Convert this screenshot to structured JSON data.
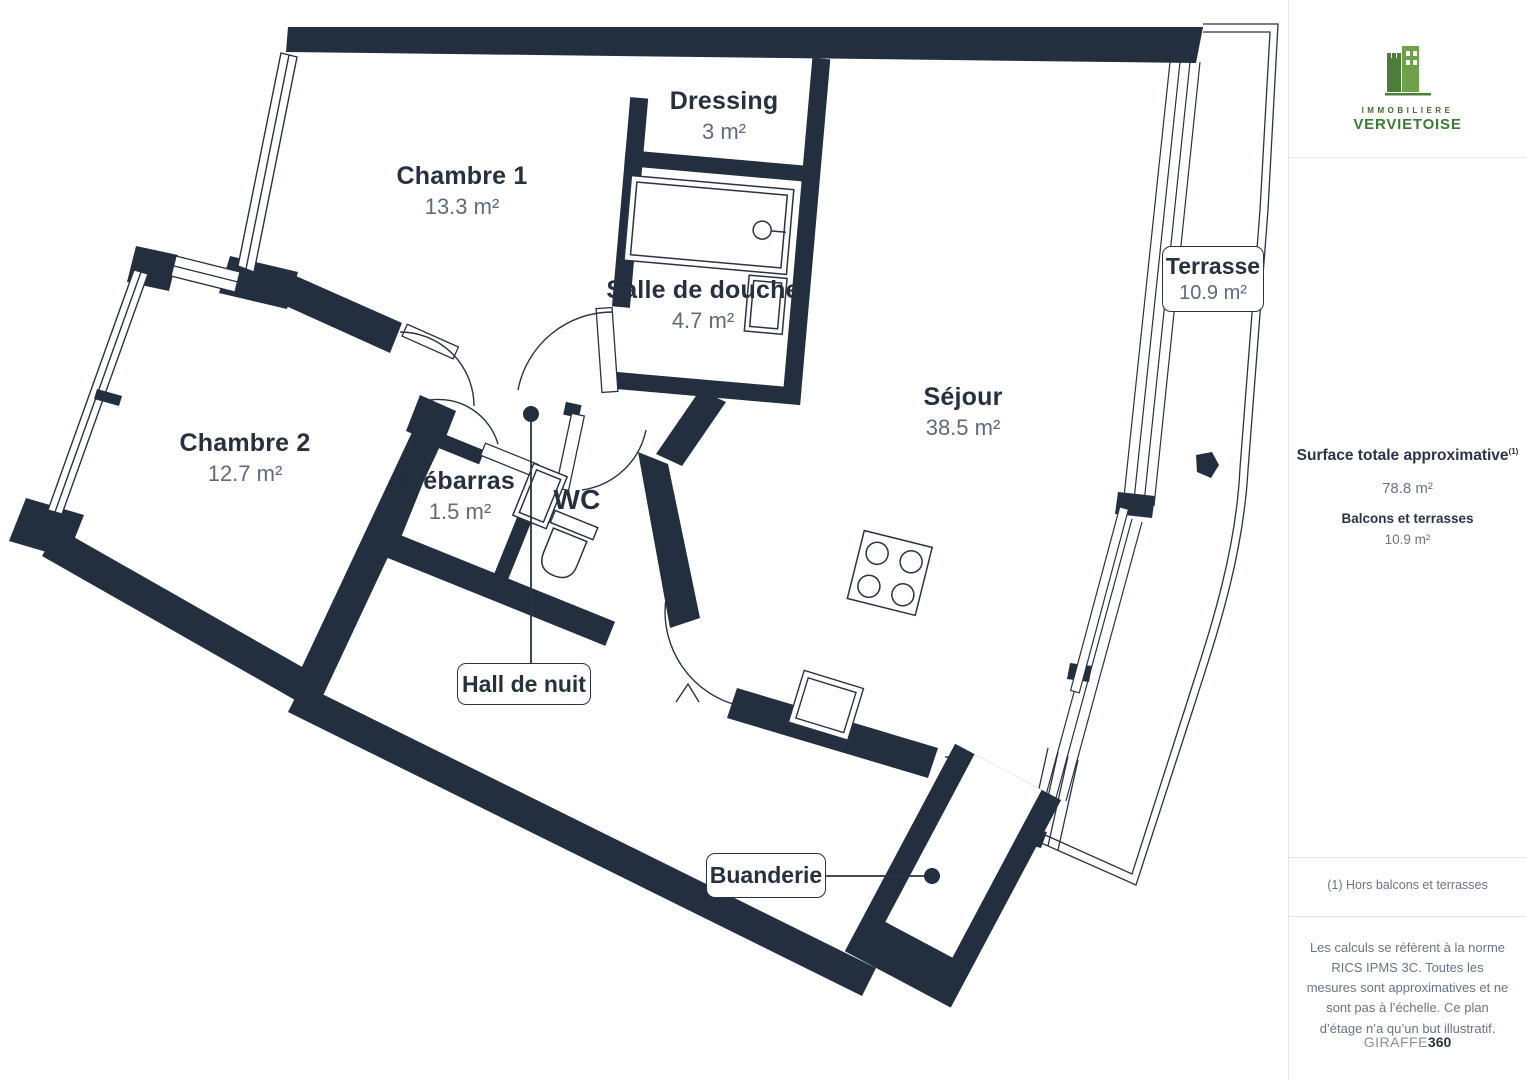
{
  "plan": {
    "rooms": [
      {
        "name": "Chambre 1",
        "area": "13.3 m²"
      },
      {
        "name": "Dressing",
        "area": "3 m²"
      },
      {
        "name": "Salle de douche",
        "area": "4.7 m²"
      },
      {
        "name": "Séjour",
        "area": "38.5 m²"
      },
      {
        "name": "Chambre 2",
        "area": "12.7 m²"
      },
      {
        "name": "Débarras",
        "area": "1.5 m²"
      },
      {
        "name": "WC",
        "area": ""
      }
    ],
    "boxed_labels": [
      {
        "name": "Hall de nuit"
      },
      {
        "name": "Buanderie"
      },
      {
        "name": "Terrasse",
        "area": "10.9 m²"
      }
    ]
  },
  "sidebar": {
    "logo": {
      "line1": "IMMOBILIERE",
      "line2": "VERVIETOISE",
      "icon": "castle-buildings-icon"
    },
    "surface_title": "Surface totale approximative",
    "surface_sup": "(1)",
    "surface_value": "78.8 m²",
    "balconies_title": "Balcons et terrasses",
    "balconies_value": "10.9 m²",
    "footnote": "(1) Hors balcons et terrasses",
    "disclaimer": "Les calculs se réfèrent à la norme RICS IPMS 3C. Toutes les mesures sont approximatives et ne sont pas à l’échelle. Ce plan d’étage n’a qu’un but illustratif.",
    "brand_name": "GIRAFFE",
    "brand_suffix": "360"
  },
  "colors": {
    "wall": "#232e3e",
    "line": "#2a3342",
    "room_text": "#27303f",
    "area_text": "#5f6a7d",
    "logo_green_dark": "#4c7d3b",
    "logo_green_light": "#6fa04c",
    "divider": "#e4e4e4"
  }
}
